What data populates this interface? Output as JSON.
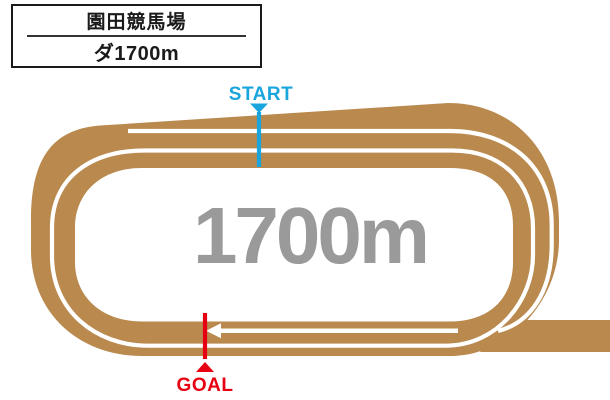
{
  "header": {
    "venue_name": "園田競馬場",
    "course_label": "ダ1700m"
  },
  "track_map": {
    "distance_text": "1700m",
    "start_label": "START",
    "goal_label": "GOAL",
    "direction": "left-arrow-on-home-stretch"
  },
  "colors": {
    "track_brown": "#B9894E",
    "start_blue": "#1BA5DD",
    "goal_red": "#E60012",
    "distance_gray": "#9A9A9B",
    "lane_line_white": "#FFFFFF"
  }
}
